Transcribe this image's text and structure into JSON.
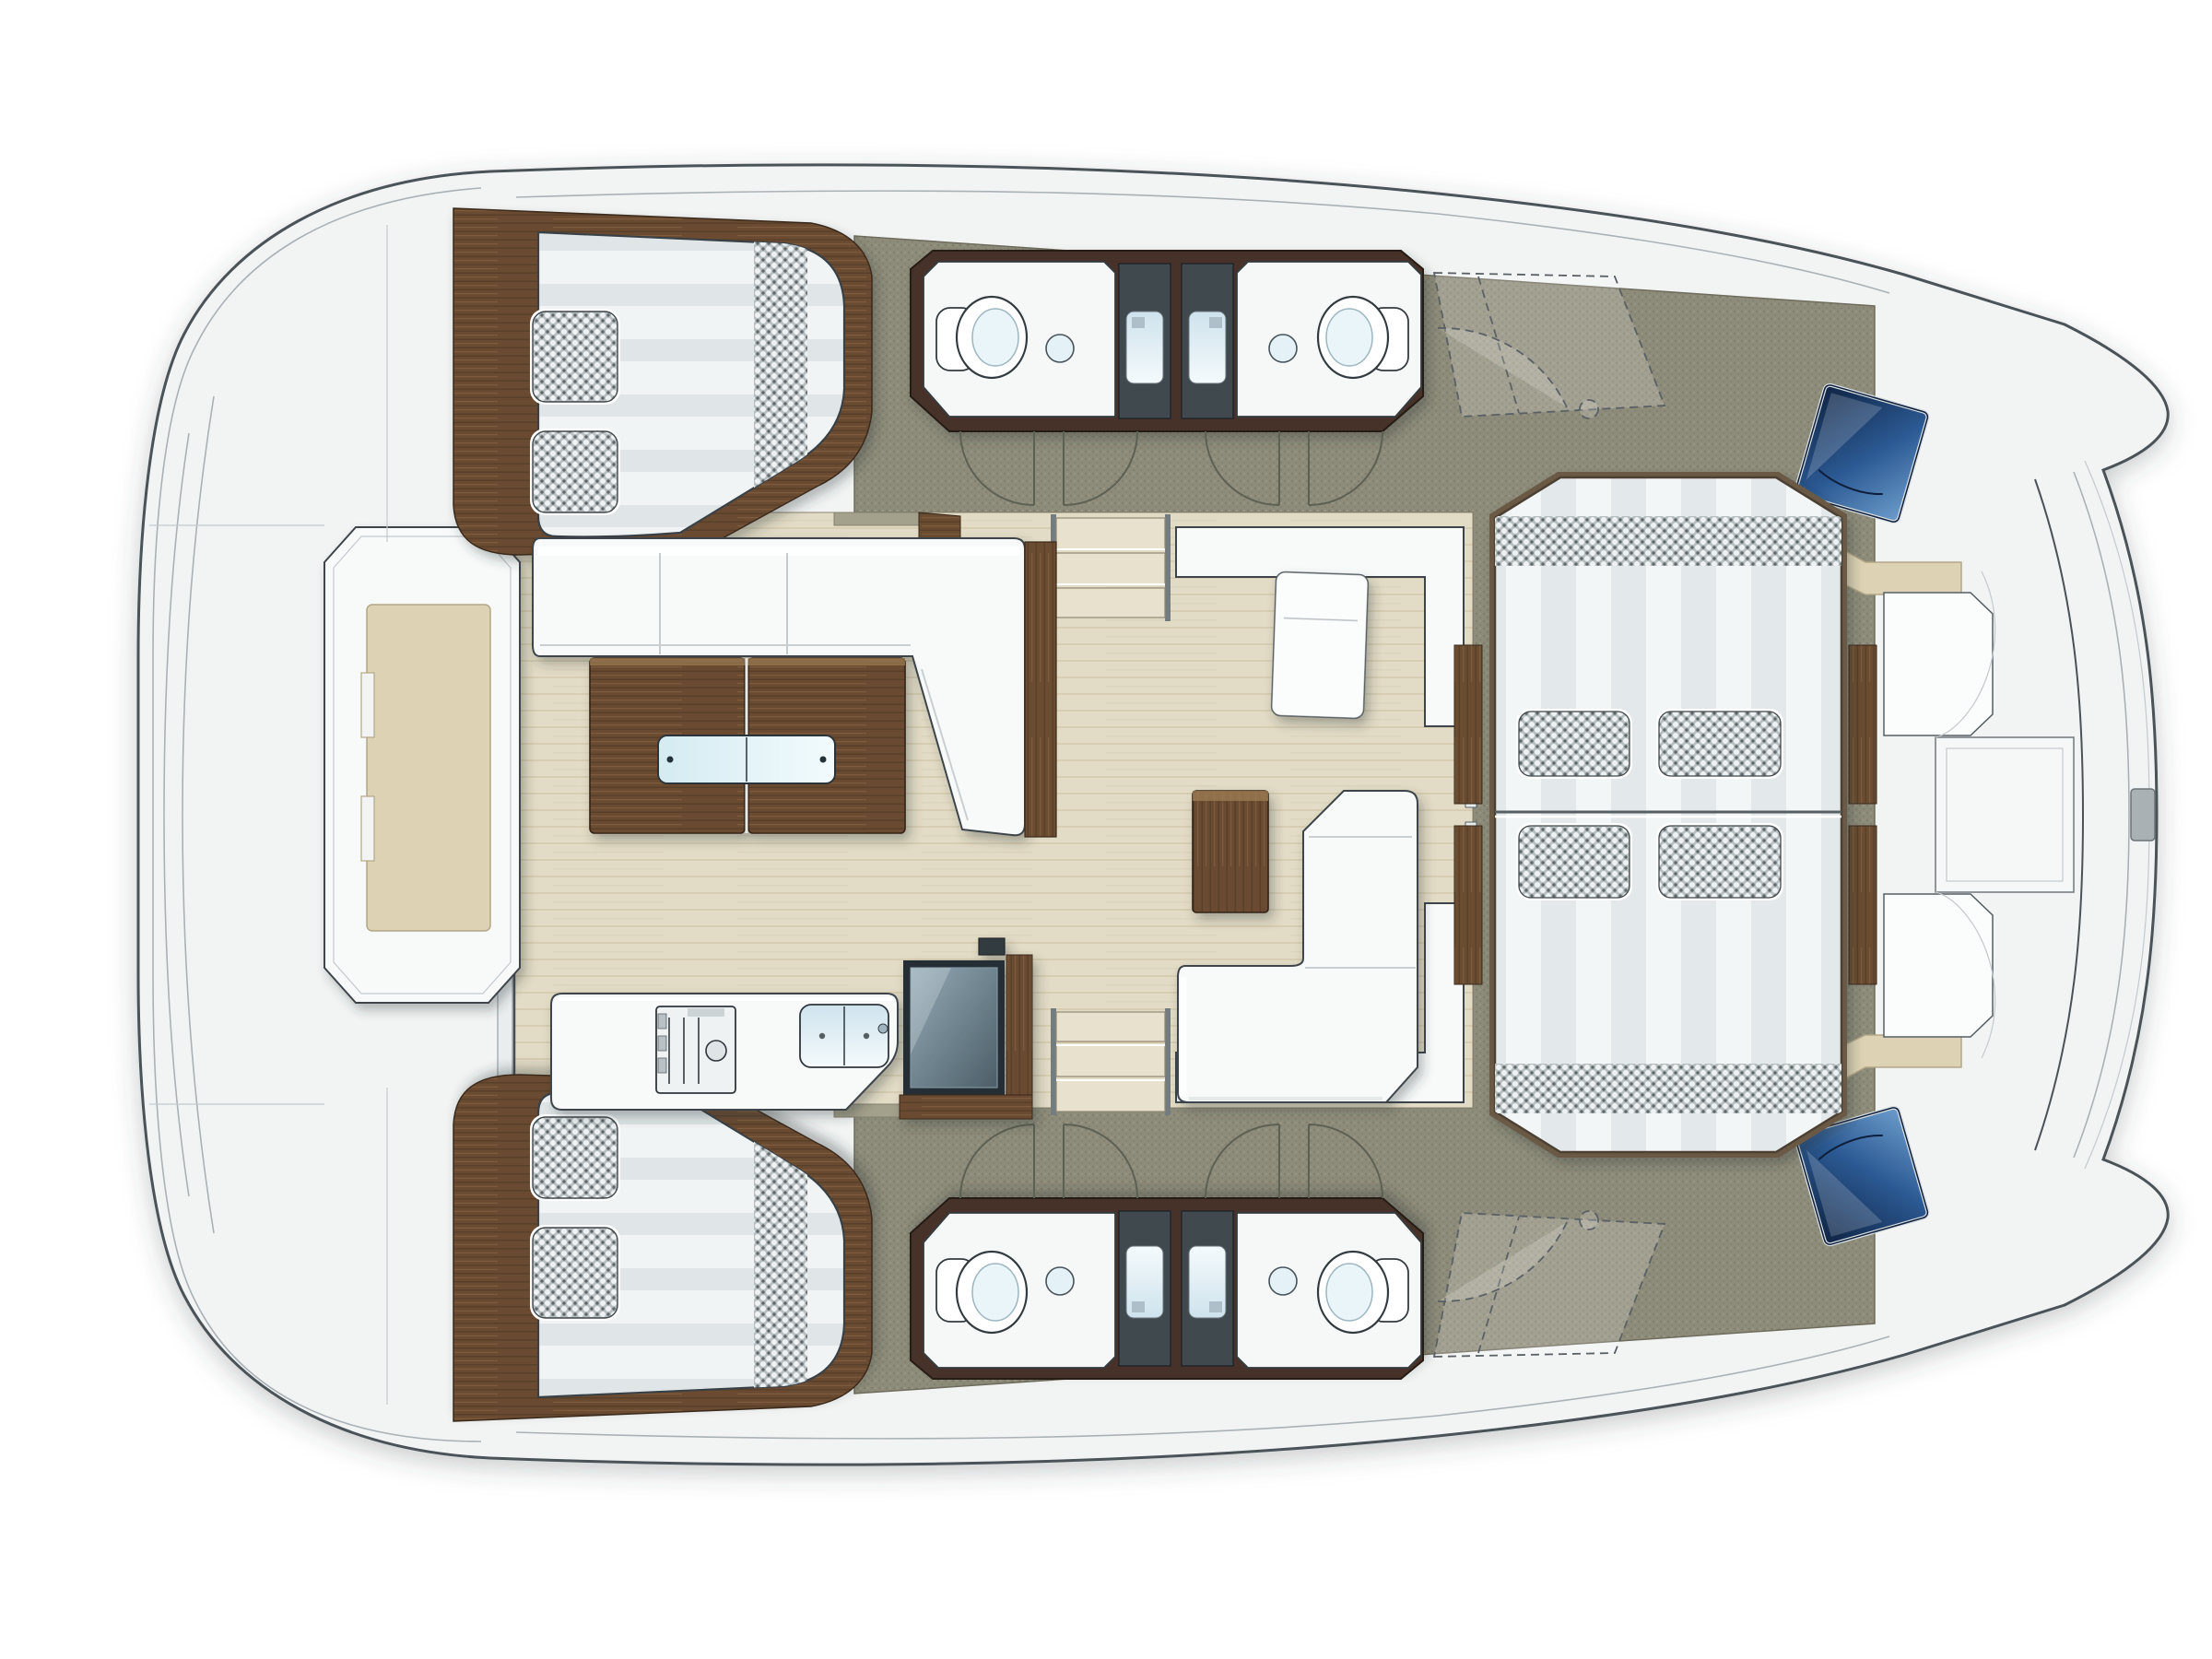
{
  "document": {
    "kind": "catamaran-deck-floor-plan",
    "orientation": {
      "bow": "right",
      "stern": "left"
    },
    "background": "#ffffff"
  },
  "palette": {
    "hull_white": "#f2f4f4",
    "outline_dark": "#4a5258",
    "deck_line": "#aab1b6",
    "floor_olive": "#8d8b79",
    "floor_wood": "#e2dbc5",
    "wood_dark": "#6a4c31",
    "wood_plank_light": "#7d5c3e",
    "wall_brown": "#46332a",
    "furniture_white": "#f8fafa",
    "mattress_stripe": "#e0e6e7",
    "checker_base": "#b6bec0",
    "checker_dot": "#5f676a",
    "beige_cushion": "#ddd2b4",
    "shower_tile": "#40484e",
    "water_blue": "#d8e9f0",
    "hatch_blue_dark": "#0e2342",
    "hatch_blue_light": "#6d9dcc",
    "step_tread": "#e8e1cd",
    "shadow": "rgba(44,50,55,0.3)"
  },
  "regions": {
    "boat": {
      "label": "catamaran deck plan"
    },
    "aft_deck": {
      "label": "aft deck platform with transom steps and center module"
    },
    "cabin_top": {
      "label": "aft cabin berth, upper hull, two checkered pillows"
    },
    "cabin_bottom": {
      "label": "aft cabin berth, lower hull, two checkered pillows"
    },
    "heads_top": {
      "label": "two head compartments with toilet, washbasin and shower"
    },
    "heads_bottom": {
      "label": "two head compartments with toilet, washbasin and shower"
    },
    "salon": {
      "label": "salon with L-sofa, dining table with glass inserts, chart seat, chaise and coffee table"
    },
    "galley": {
      "label": "galley counter with cooktop, double sink and refrigerator"
    },
    "forward_cockpit": {
      "label": "forward cockpit sunpad with four cushions and teak side rails"
    },
    "bow_area": {
      "label": "bow platform with bench seats, console, hatch windows and bow rails"
    }
  },
  "counts": {
    "berths": 2,
    "toilets": 4,
    "washbasins": 4,
    "showers": 4,
    "sunpad_cushions": 4,
    "companionway_stairs": 2,
    "hatch_windows": 2,
    "door_swings": 8
  }
}
